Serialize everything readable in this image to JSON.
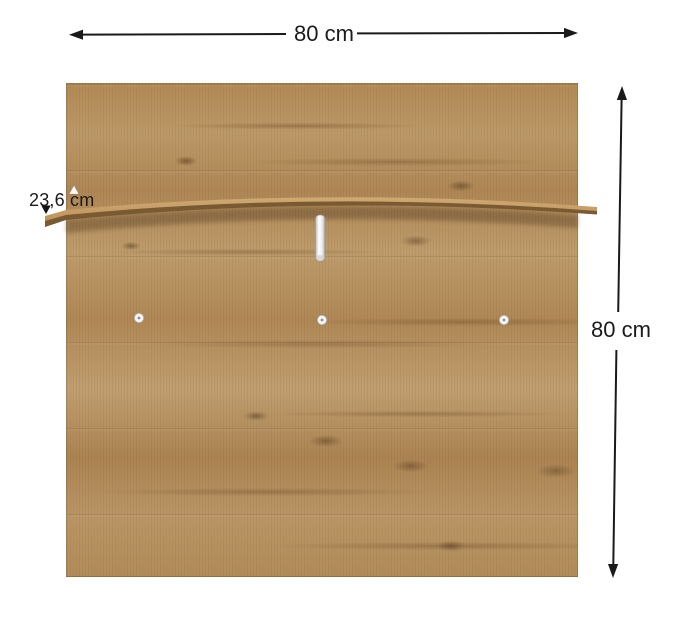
{
  "diagram": {
    "type": "furniture-dimension-diagram",
    "subject": "wall-mounted wooden panel with shelf",
    "labels": {
      "width": "80 cm",
      "height": "80 cm",
      "shelf_depth": "23,6 cm"
    },
    "hardware": {
      "hook_count": 1,
      "screw_cap_count": 3
    },
    "colors": {
      "background": "#ffffff",
      "wood_base": "#b48e5c",
      "wood_grain_dark": "#7a5a33",
      "wood_highlight": "#c7a066",
      "dimension_line": "#1a1a1a",
      "hardware_white": "#f4f4f4"
    }
  }
}
